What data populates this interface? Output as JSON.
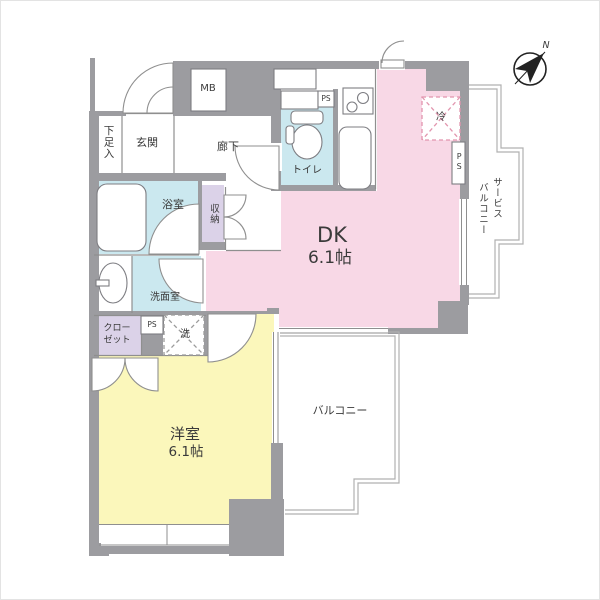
{
  "colors": {
    "wall": "#9c9ca0",
    "dk_pink": "#f8d8e6",
    "room_yellow": "#fbf7bb",
    "wet_blue": "#cbe8ef",
    "storage_purple": "#dbd2e8",
    "fixture_line": "#7d7d82",
    "thin_line": "#8f8f8f",
    "railing": "#b0b0b0",
    "fridge_dash": "#e295ae",
    "washer_dash": "#9b9b9b",
    "compass_ink": "#222222",
    "text": "#3a3a3a"
  },
  "labels": {
    "shoe_box": "下足入",
    "entrance": "玄関",
    "meter_box": "MB",
    "hallway": "廊下",
    "toilet": "トイレ",
    "ps_toilet": "PS",
    "refrigerator": "冷",
    "dk_name": "DK",
    "dk_size": "6.1帖",
    "service_balcony_line1": "サービス",
    "service_balcony_line2": "バルコニー",
    "ps_service": "PS",
    "bathroom": "浴室",
    "storage": "収納",
    "washroom": "洗面室",
    "closet_line1": "クロー",
    "closet_line2": "ゼット",
    "ps_washroom": "PS",
    "washer": "洗",
    "western_room_name": "洋室",
    "western_room_size": "6.1帖",
    "balcony": "バルコニー",
    "compass_north": "N"
  }
}
